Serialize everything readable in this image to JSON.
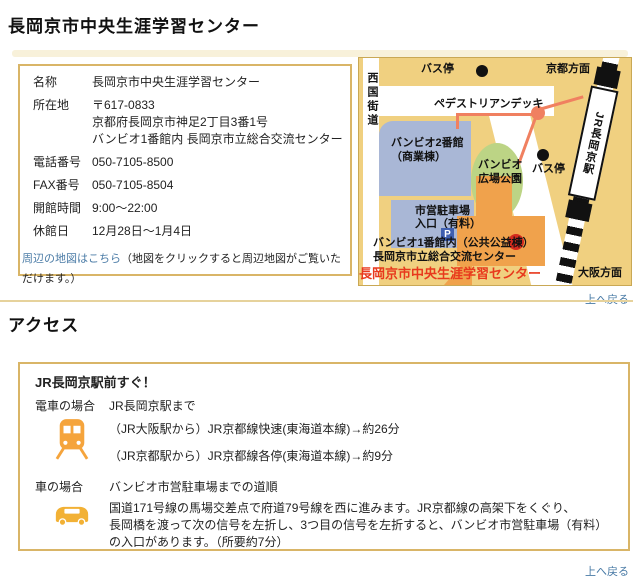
{
  "colors": {
    "border_tan": "#d9b567",
    "map_bg": "#f0d080",
    "building_blue": "#a9b7d6",
    "park_green": "#bcd485",
    "bambio1_orange": "#f0a24c",
    "deck_salmon": "#f08060",
    "marker_red": "#d42b1e",
    "facility_red": "#e8391d",
    "link_blue": "#4a7ba6",
    "icon_orange": "#f5a43c"
  },
  "page": {
    "title": "長岡京市中央生涯学習センター",
    "back_to_top": "上へ戻る"
  },
  "info": {
    "rows": [
      {
        "label": "名称",
        "lines": [
          "長岡京市中央生涯学習センター"
        ]
      },
      {
        "label": "所在地",
        "lines": [
          "〒617-0833",
          "京都府長岡京市神足2丁目3番1号",
          "バンビオ1番館内 長岡京市立総合交流センター"
        ]
      },
      {
        "label": "電話番号",
        "lines": [
          "050-7105-8500"
        ]
      },
      {
        "label": "FAX番号",
        "lines": [
          "050-7105-8504"
        ]
      },
      {
        "label": "開館時間",
        "lines": [
          "9:00～22:00"
        ]
      },
      {
        "label": "休館日",
        "lines": [
          "12月28日～1月4日"
        ]
      }
    ],
    "map_note_link": "周辺の地図はこちら",
    "map_note_rest": "（地図をクリックすると周辺地図がご覧いただけます。）"
  },
  "map": {
    "west_road": "西国街道",
    "bus_stop_top": "バス停",
    "kyoto_direction": "京都方面",
    "pedestrian_deck": "ペデストリアンデッキ",
    "station_name": "JR長岡京駅",
    "bambio2_line1": "バンビオ2番館",
    "bambio2_line2": "（商業棟）",
    "park_line1": "バンビオ",
    "park_line2": "広場公園",
    "bus_stop_right": "バス停",
    "parking_line1": "市営駐車場",
    "parking_line2": "入口（有料）",
    "parking_symbol": "P",
    "bambio1_label": "バンビオ1番館内（公共公益棟）",
    "exchange_center": "長岡京市立総合交流センター",
    "facility_label": "長岡京市中央生涯学習センター",
    "osaka_direction": "大阪方面"
  },
  "access": {
    "heading": "アクセス",
    "highlight": "JR長岡京駅前すぐ！",
    "train_label": "電車の場合",
    "train_dest": "JR長岡京駅まで",
    "train_lines": [
      "（JR大阪駅から）JR京都線快速(東海道本線)→約26分",
      "（JR京都駅から）JR京都線各停(東海道本線)→約9分"
    ],
    "car_label": "車の場合",
    "car_dest": "バンビオ市営駐車場までの道順",
    "car_lines": [
      "国道171号線の馬場交差点で府道79号線を西に進みます。JR京都線の高架下をくぐり、",
      "長岡橋を渡って次の信号を左折し、3つ目の信号を左折すると、バンビオ市営駐車場（有料）",
      "の入口があります。（所要約7分）"
    ]
  }
}
